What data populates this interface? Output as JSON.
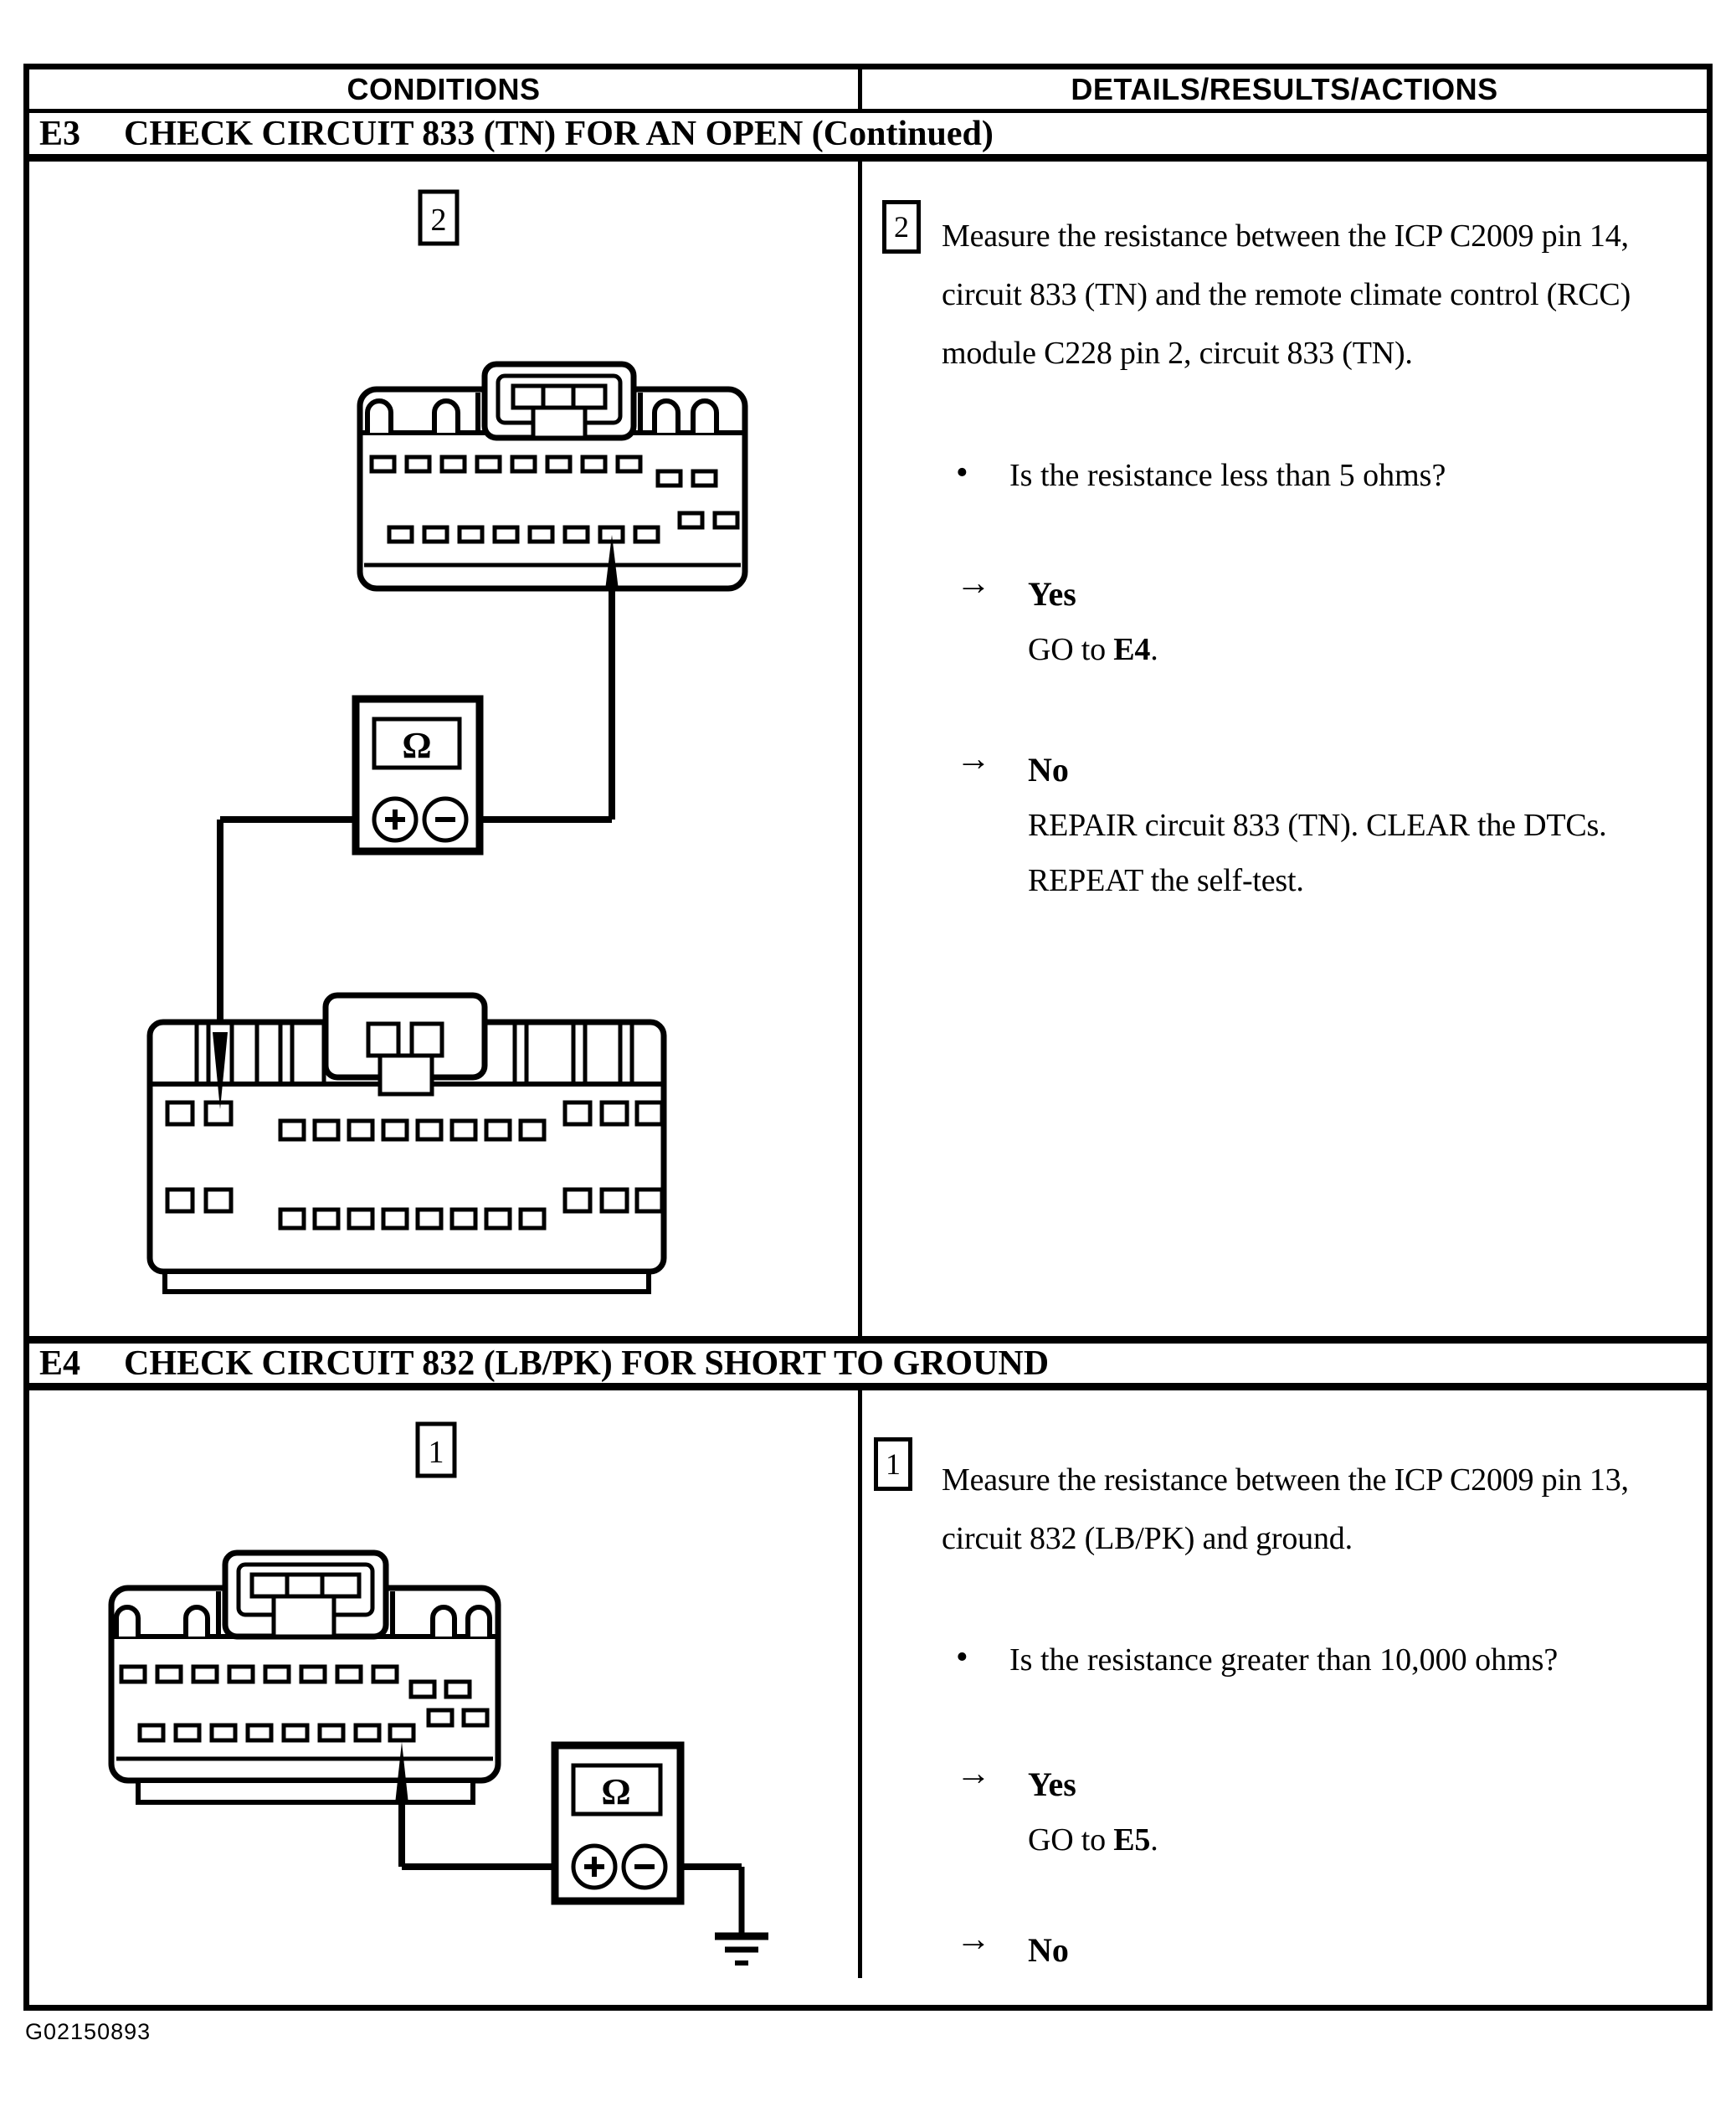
{
  "page": {
    "footer_code": "G02150893"
  },
  "colors": {
    "ink": "#000000",
    "paper": "#ffffff"
  },
  "table": {
    "columns": {
      "left": "CONDITIONS",
      "right": "DETAILS/RESULTS/ACTIONS"
    },
    "sections": [
      {
        "id": "E3",
        "title": "CHECK CIRCUIT 833 (TN) FOR AN OPEN (Continued)",
        "step": {
          "number": "2",
          "text": "Measure the resistance between the ICP C2009 pin 14, circuit 833 (TN) and the remote climate control (RCC) module C228 pin 2, circuit 833 (TN)."
        },
        "question": {
          "bullet": "•",
          "text": "Is the resistance less than 5 ohms?"
        },
        "yes": {
          "arrow": "→",
          "label": "Yes",
          "action_prefix": "GO to ",
          "action_target": "E4",
          "action_suffix": "."
        },
        "no": {
          "arrow": "→",
          "label": "No",
          "action": "REPAIR circuit 833 (TN). CLEAR the DTCs. REPEAT the self-test."
        },
        "diagram": {
          "step_badge": "2",
          "meter": {
            "display": "Ω",
            "plus": "+",
            "minus": "−"
          }
        }
      },
      {
        "id": "E4",
        "title": "CHECK CIRCUIT 832 (LB/PK) FOR SHORT TO GROUND",
        "step": {
          "number": "1",
          "text": "Measure the resistance between the ICP C2009 pin 13, circuit 832 (LB/PK) and ground."
        },
        "question": {
          "bullet": "•",
          "text": "Is the resistance greater than 10,000 ohms?"
        },
        "yes": {
          "arrow": "→",
          "label": "Yes",
          "action_prefix": "GO to ",
          "action_target": "E5",
          "action_suffix": "."
        },
        "no": {
          "arrow": "→",
          "label": "No",
          "action": "REPAIR circuit 832 (LB/PK). CLEAR the DTCs. REPEAT the self-test."
        },
        "diagram": {
          "step_badge": "1",
          "meter": {
            "display": "Ω",
            "plus": "+",
            "minus": "−"
          }
        }
      }
    ]
  }
}
